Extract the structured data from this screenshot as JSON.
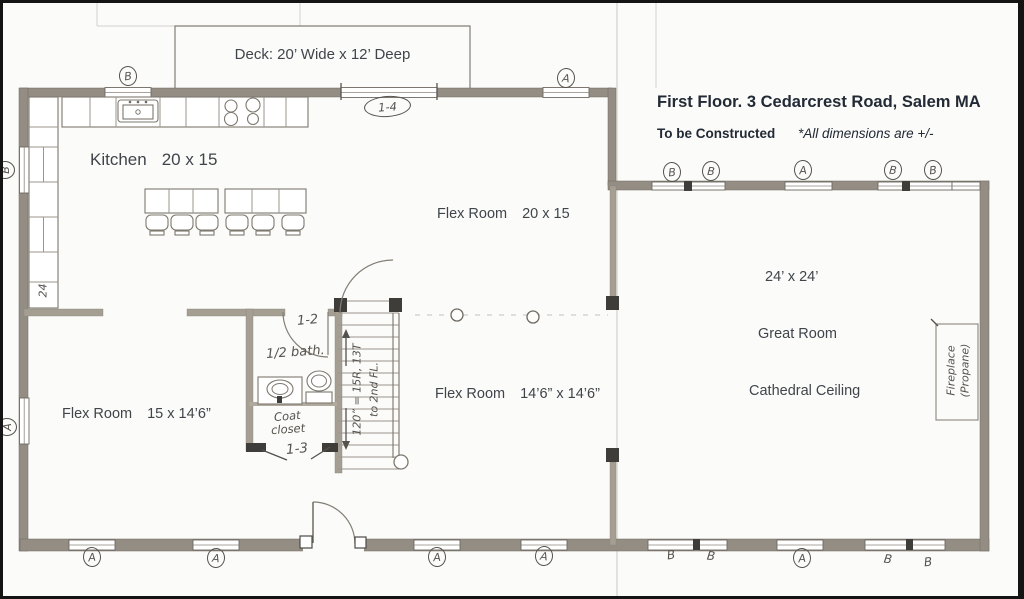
{
  "title": {
    "line1": "First Floor. 3 Cedarcrest Road, Salem MA",
    "line2_bold": "To be Constructed",
    "line2_italic": "*All dimensions are +/-"
  },
  "deck": {
    "label": "Deck: 20’ Wide x 12’ Deep"
  },
  "rooms": {
    "kitchen": {
      "name": "Kitchen",
      "dims": "20 x 15"
    },
    "flex_top": {
      "name": "Flex Room",
      "dims": "20 x 15"
    },
    "flex_left": {
      "name": "Flex Room",
      "dims": "15 x 14’6”"
    },
    "flex_mid": {
      "name": "Flex Room",
      "dims": "14’6” x 14’6”"
    },
    "great_room": {
      "dims": "24’ x 24’",
      "name": "Great Room",
      "ceiling": "Cathedral Ceiling"
    }
  },
  "annotations": {
    "door_1_2": "1-2",
    "door_1_3": "1-3",
    "door_1_4": "1-4",
    "half_bath": "1/2 bath.",
    "coat_line1": "Coat",
    "coat_line2": "closet",
    "stairs_note_line1": "120” = 15R, 13T",
    "stairs_note_line2": "to 2nd FL.",
    "fireplace_line1": "Fireplace",
    "fireplace_line2": "(Propane)",
    "left_wall_dim": "24"
  },
  "markers": [
    {
      "label": "B"
    },
    {
      "label": "A"
    },
    {
      "label": "B"
    },
    {
      "label": "B"
    },
    {
      "label": "A"
    },
    {
      "label": "B"
    },
    {
      "label": "B"
    },
    {
      "label": "B"
    },
    {
      "label": "A"
    },
    {
      "label": "A"
    },
    {
      "label": "A"
    },
    {
      "label": "A"
    },
    {
      "label": "A"
    },
    {
      "label": "B"
    },
    {
      "label": "B"
    },
    {
      "label": "A"
    },
    {
      "label": "B"
    },
    {
      "label": "B"
    }
  ]
}
